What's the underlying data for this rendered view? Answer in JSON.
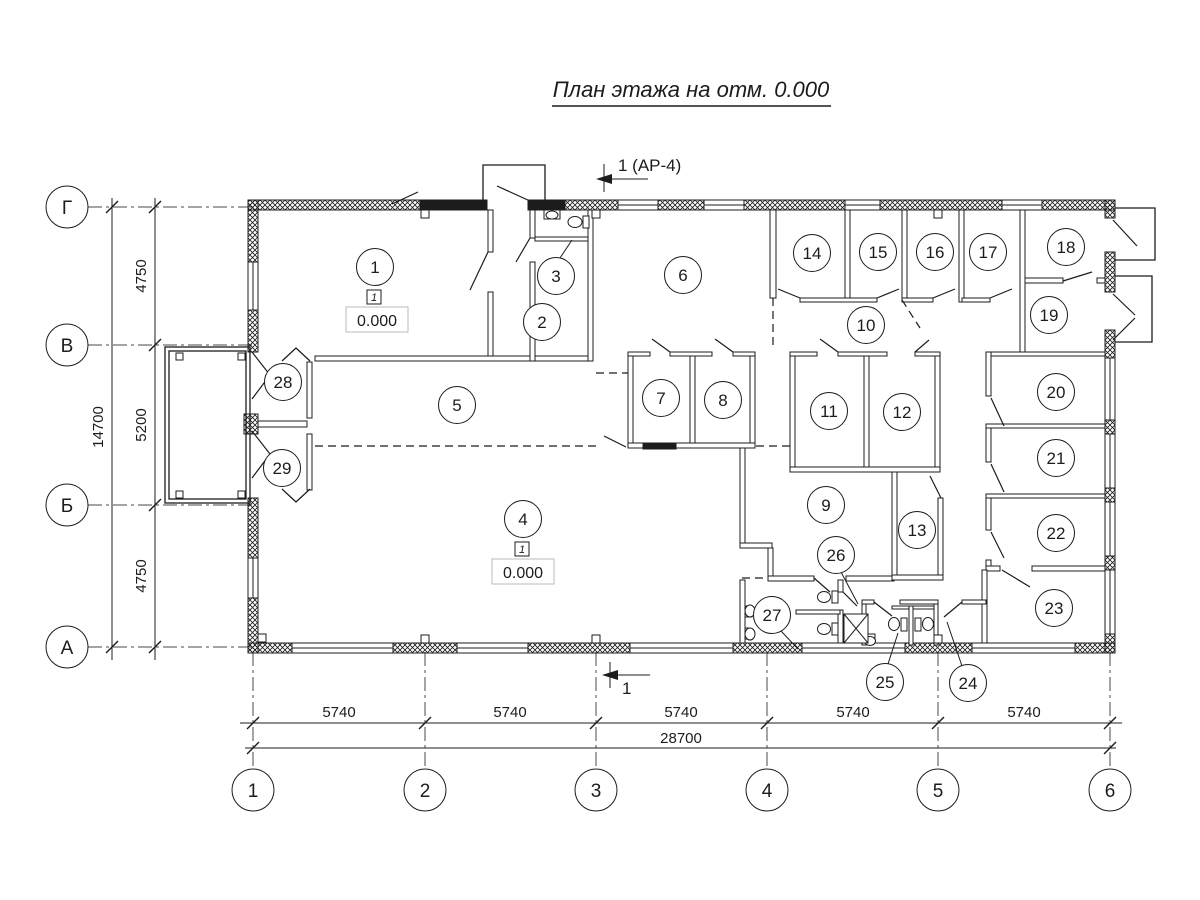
{
  "title": "План этажа на отм. 0.000",
  "section_marks": {
    "top": "1 (АР-4)",
    "bottom": "1"
  },
  "colors": {
    "ink": "#1c1c1c",
    "background": "#ffffff"
  },
  "axes": {
    "rows": [
      {
        "label": "Г",
        "y": 207
      },
      {
        "label": "В",
        "y": 345
      },
      {
        "label": "Б",
        "y": 505
      },
      {
        "label": "А",
        "y": 647
      }
    ],
    "cols": [
      {
        "label": "1",
        "x": 253
      },
      {
        "label": "2",
        "x": 425
      },
      {
        "label": "3",
        "x": 596
      },
      {
        "label": "4",
        "x": 767
      },
      {
        "label": "5",
        "x": 938
      },
      {
        "label": "6",
        "x": 1110
      }
    ]
  },
  "dimensions": {
    "vertical": [
      {
        "value": "4750",
        "x": 146,
        "y": 276
      },
      {
        "value": "5200",
        "x": 146,
        "y": 425
      },
      {
        "value": "4750",
        "x": 146,
        "y": 576
      },
      {
        "value": "14700",
        "x": 103,
        "y": 427
      }
    ],
    "horizontal": [
      {
        "value": "5740",
        "x": 339,
        "y": 717
      },
      {
        "value": "5740",
        "x": 510,
        "y": 717
      },
      {
        "value": "5740",
        "x": 681,
        "y": 717
      },
      {
        "value": "5740",
        "x": 853,
        "y": 717
      },
      {
        "value": "5740",
        "x": 1024,
        "y": 717
      },
      {
        "value": "28700",
        "x": 681,
        "y": 743
      }
    ]
  },
  "rooms": [
    {
      "n": "1",
      "x": 375,
      "y": 267
    },
    {
      "n": "2",
      "x": 542,
      "y": 322
    },
    {
      "n": "3",
      "x": 556,
      "y": 276
    },
    {
      "n": "4",
      "x": 523,
      "y": 519
    },
    {
      "n": "5",
      "x": 457,
      "y": 405
    },
    {
      "n": "6",
      "x": 683,
      "y": 275
    },
    {
      "n": "7",
      "x": 661,
      "y": 398
    },
    {
      "n": "8",
      "x": 723,
      "y": 400
    },
    {
      "n": "9",
      "x": 826,
      "y": 505
    },
    {
      "n": "10",
      "x": 866,
      "y": 325
    },
    {
      "n": "11",
      "x": 829,
      "y": 411
    },
    {
      "n": "12",
      "x": 902,
      "y": 412
    },
    {
      "n": "13",
      "x": 917,
      "y": 530
    },
    {
      "n": "14",
      "x": 812,
      "y": 253
    },
    {
      "n": "15",
      "x": 878,
      "y": 252
    },
    {
      "n": "16",
      "x": 935,
      "y": 252
    },
    {
      "n": "17",
      "x": 988,
      "y": 252
    },
    {
      "n": "18",
      "x": 1066,
      "y": 247
    },
    {
      "n": "19",
      "x": 1049,
      "y": 315
    },
    {
      "n": "20",
      "x": 1056,
      "y": 392
    },
    {
      "n": "21",
      "x": 1056,
      "y": 458
    },
    {
      "n": "22",
      "x": 1056,
      "y": 533
    },
    {
      "n": "23",
      "x": 1054,
      "y": 608
    },
    {
      "n": "24",
      "x": 968,
      "y": 683
    },
    {
      "n": "25",
      "x": 885,
      "y": 682
    },
    {
      "n": "26",
      "x": 836,
      "y": 555
    },
    {
      "n": "27",
      "x": 772,
      "y": 615
    },
    {
      "n": "28",
      "x": 283,
      "y": 382
    },
    {
      "n": "29",
      "x": 282,
      "y": 468
    }
  ],
  "floor_markers": [
    {
      "marker": "1",
      "value": "0.000",
      "marker_x": 374,
      "marker_y": 297,
      "box_x": 377,
      "box_y": 320
    },
    {
      "marker": "1",
      "value": "0.000",
      "marker_x": 522,
      "marker_y": 549,
      "box_x": 523,
      "box_y": 572
    }
  ]
}
